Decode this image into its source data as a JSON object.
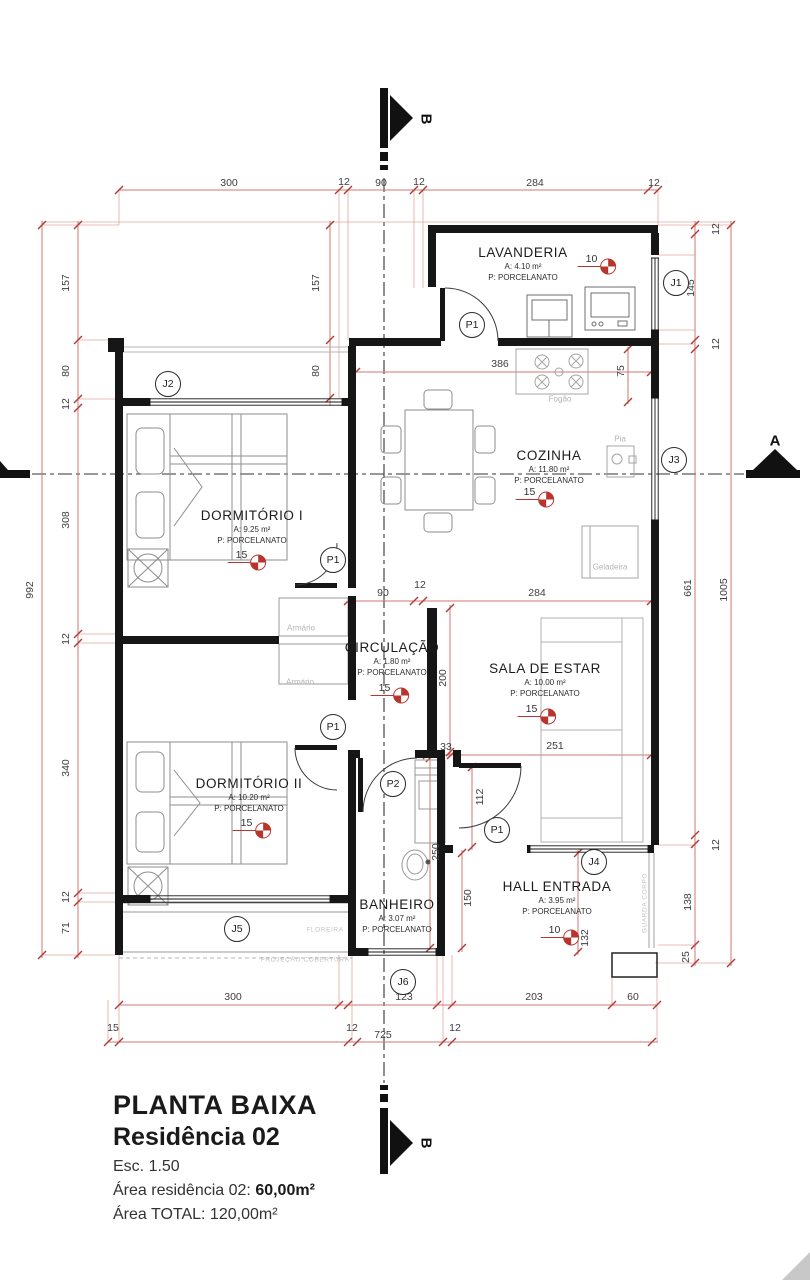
{
  "title_block": {
    "title": "PLANTA BAIXA",
    "subtitle": "Residência 02",
    "scale": "Esc. 1.50",
    "area_label": "Área residência 02:",
    "area_value": "60,00m²",
    "total": "Área TOTAL: 120,00m²"
  },
  "colors": {
    "wall": "#161616",
    "dimension_line": "#cf7a72",
    "dimension_tick": "#b23b35",
    "level_symbol": "#b8352e",
    "furniture": "#8e8e8e",
    "faint_text": "#b3b3b3"
  },
  "drawing": {
    "rooms": [
      {
        "id": "lavanderia",
        "name": "LAVANDERIA",
        "area": "A: 4.10 m²",
        "floor": "P: PORCELANATO",
        "x": 523,
        "y": 245
      },
      {
        "id": "cozinha",
        "name": "COZINHA",
        "area": "A: 11.80 m²",
        "floor": "P: PORCELANATO",
        "x": 549,
        "y": 448
      },
      {
        "id": "dormitorio-1",
        "name": "DORMITÓRIO I",
        "area": "A: 9.25 m²",
        "floor": "P: PORCELANATO",
        "x": 252,
        "y": 508
      },
      {
        "id": "circulacao",
        "name": "CIRCULAÇÃO",
        "area": "A: 1.80 m²",
        "floor": "P: PORCELANATO",
        "x": 392,
        "y": 640
      },
      {
        "id": "sala-de-estar",
        "name": "SALA DE ESTAR",
        "area": "A: 10.00 m²",
        "floor": "P: PORCELANATO",
        "x": 545,
        "y": 661
      },
      {
        "id": "dormitorio-2",
        "name": "DORMITÓRIO II",
        "area": "A: 10.20 m²",
        "floor": "P: PORCELANATO",
        "x": 249,
        "y": 776
      },
      {
        "id": "banheiro",
        "name": "BANHEIRO",
        "area": "A: 3.07 m²",
        "floor": "P: PORCELANATO",
        "x": 397,
        "y": 897
      },
      {
        "id": "hall-entrada",
        "name": "HALL ENTRADA",
        "area": "A: 3.95 m²",
        "floor": "P: PORCELANATO",
        "x": 557,
        "y": 879
      }
    ],
    "levels": [
      {
        "value": "10",
        "x": 597,
        "y": 260
      },
      {
        "value": "15",
        "x": 535,
        "y": 493
      },
      {
        "value": "15",
        "x": 247,
        "y": 556
      },
      {
        "value": "15",
        "x": 390,
        "y": 689
      },
      {
        "value": "15",
        "x": 537,
        "y": 710
      },
      {
        "value": "15",
        "x": 252,
        "y": 824
      },
      {
        "value": "10",
        "x": 560,
        "y": 931
      }
    ],
    "openings": [
      {
        "label": "J1",
        "x": 676,
        "y": 283
      },
      {
        "label": "J2",
        "x": 168,
        "y": 384
      },
      {
        "label": "J3",
        "x": 674,
        "y": 460
      },
      {
        "label": "J4",
        "x": 594,
        "y": 862
      },
      {
        "label": "J5",
        "x": 237,
        "y": 929
      },
      {
        "label": "J6",
        "x": 403,
        "y": 982
      },
      {
        "label": "P1",
        "x": 472,
        "y": 325
      },
      {
        "label": "P1",
        "x": 333,
        "y": 560
      },
      {
        "label": "P1",
        "x": 333,
        "y": 727
      },
      {
        "label": "P1",
        "x": 497,
        "y": 830
      },
      {
        "label": "P2",
        "x": 393,
        "y": 784
      }
    ],
    "dimensions": [
      {
        "value": "300",
        "x": 229,
        "y": 183
      },
      {
        "value": "12",
        "x": 344,
        "y": 182
      },
      {
        "value": "90",
        "x": 381,
        "y": 183
      },
      {
        "value": "12",
        "x": 419,
        "y": 182
      },
      {
        "value": "284",
        "x": 535,
        "y": 183
      },
      {
        "value": "12",
        "x": 654,
        "y": 183
      },
      {
        "value": "157",
        "x": 316,
        "y": 283,
        "rot": true
      },
      {
        "value": "80",
        "x": 316,
        "y": 371,
        "rot": true
      },
      {
        "value": "386",
        "x": 500,
        "y": 364
      },
      {
        "value": "75",
        "x": 621,
        "y": 371,
        "rot": true
      },
      {
        "value": "90",
        "x": 383,
        "y": 593
      },
      {
        "value": "12",
        "x": 420,
        "y": 585
      },
      {
        "value": "284",
        "x": 537,
        "y": 593
      },
      {
        "value": "200",
        "x": 443,
        "y": 678,
        "rot": true
      },
      {
        "value": "33",
        "x": 446,
        "y": 747
      },
      {
        "value": "251",
        "x": 555,
        "y": 746
      },
      {
        "value": "112",
        "x": 480,
        "y": 797,
        "rot": true
      },
      {
        "value": "250",
        "x": 436,
        "y": 852,
        "rot": true
      },
      {
        "value": "150",
        "x": 468,
        "y": 898,
        "rot": true
      },
      {
        "value": "132",
        "x": 585,
        "y": 938,
        "rot": true
      },
      {
        "value": "300",
        "x": 233,
        "y": 997
      },
      {
        "value": "123",
        "x": 404,
        "y": 997
      },
      {
        "value": "203",
        "x": 534,
        "y": 997
      },
      {
        "value": "60",
        "x": 633,
        "y": 997
      },
      {
        "value": "15",
        "x": 113,
        "y": 1028
      },
      {
        "value": "12",
        "x": 352,
        "y": 1028
      },
      {
        "value": "725",
        "x": 383,
        "y": 1035
      },
      {
        "value": "12",
        "x": 455,
        "y": 1028
      },
      {
        "value": "157",
        "x": 66,
        "y": 283,
        "rot": true
      },
      {
        "value": "80",
        "x": 66,
        "y": 371,
        "rot": true
      },
      {
        "value": "12",
        "x": 66,
        "y": 404,
        "rot": true
      },
      {
        "value": "308",
        "x": 66,
        "y": 520,
        "rot": true
      },
      {
        "value": "12",
        "x": 66,
        "y": 639,
        "rot": true
      },
      {
        "value": "340",
        "x": 66,
        "y": 768,
        "rot": true
      },
      {
        "value": "12",
        "x": 66,
        "y": 897,
        "rot": true
      },
      {
        "value": "71",
        "x": 66,
        "y": 928,
        "rot": true
      },
      {
        "value": "992",
        "x": 30,
        "y": 590,
        "rot": true
      },
      {
        "value": "12",
        "x": 716,
        "y": 229,
        "rot": true
      },
      {
        "value": "145",
        "x": 691,
        "y": 288,
        "rot": true
      },
      {
        "value": "12",
        "x": 716,
        "y": 344,
        "rot": true
      },
      {
        "value": "661",
        "x": 688,
        "y": 588,
        "rot": true
      },
      {
        "value": "1005",
        "x": 724,
        "y": 590,
        "rot": true
      },
      {
        "value": "12",
        "x": 716,
        "y": 845,
        "rot": true
      },
      {
        "value": "138",
        "x": 688,
        "y": 902,
        "rot": true
      },
      {
        "value": "25",
        "x": 686,
        "y": 957,
        "rot": true
      }
    ],
    "fixtures": [
      {
        "label": "Fogão",
        "x": 560,
        "y": 399
      },
      {
        "label": "Pia",
        "x": 620,
        "y": 439
      },
      {
        "label": "Geladeira",
        "x": 610,
        "y": 567
      },
      {
        "label": "Armário",
        "x": 301,
        "y": 628
      },
      {
        "label": "Armário",
        "x": 300,
        "y": 682
      },
      {
        "label": "FLOREIRA",
        "x": 325,
        "y": 930,
        "small": true
      },
      {
        "label": "PROJEÇÃO COBERTURA",
        "x": 305,
        "y": 960,
        "small": true
      },
      {
        "label": "GUARDA CORPO",
        "x": 645,
        "y": 903,
        "rot": true,
        "small": true
      }
    ],
    "sections": [
      {
        "label": "B",
        "x": 426,
        "y": 119,
        "rot": true
      },
      {
        "label": "B",
        "x": 426,
        "y": 1143,
        "rot": true
      },
      {
        "label": "A",
        "x": 775,
        "y": 441
      }
    ]
  }
}
